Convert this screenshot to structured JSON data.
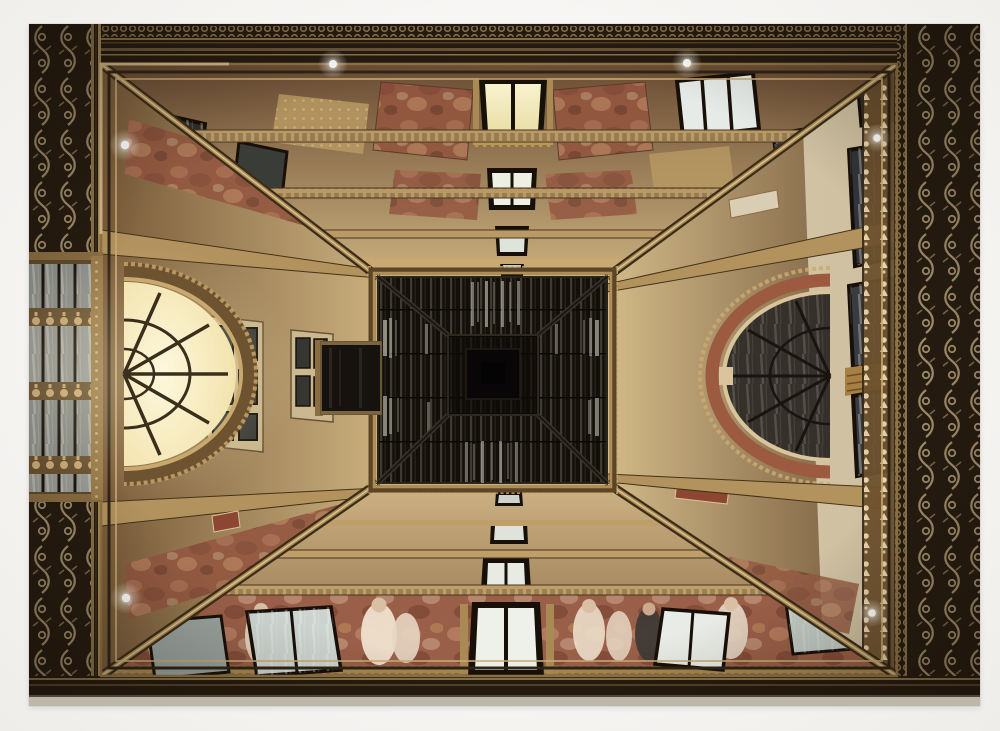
{
  "image": {
    "type": "framed photographic print",
    "subject": "Upward view of an ornate gallery courtyard (Galleria-style atrium): four frescoed walls with rows of windows converge on a dark rectangular glass skylight; a glowing arched lunette window on the left wall, a terracotta arch on the right wall, painted figures along the bottom wall, and a dark gilded ornamental cornice framing the edges",
    "orientation": "landscape",
    "mat_style": "white gallery mat"
  },
  "palette": {
    "mat": "#f4f3f0",
    "border_dark": "#251b10",
    "border_ornament": "#c6b186",
    "molding_gold": "#a98a55",
    "molding_dark": "#3a2c19",
    "molding_bright": "#e2cb99",
    "wall_tan": "#c2a875",
    "wall_cream": "#d6c9a9",
    "wall_deep": "#6f5636",
    "fresco_red": "#935740",
    "fresco_rose": "#9a5f48",
    "glass_dark": "#2e2f2c",
    "glass_cool": "#eef1ea",
    "glass_warm": "#f6efc9",
    "glow_warm": "#fdf8dd",
    "arch_terracotta": "#9c5a40",
    "skylight_dark": "#14110c",
    "skylight_glass": "#3f3b33",
    "lamp": "#ffffff"
  },
  "features": {
    "skylight": "dark pyramidal glass skylight, off-center left",
    "left_wall": "glowing half-ellipse lunette window with radial mullions",
    "right_wall": "terracotta arch ring with dark glazing and column loggia",
    "bottom_wall": "fresco band with standing figures in pale dresses",
    "lamps_count": 6
  }
}
